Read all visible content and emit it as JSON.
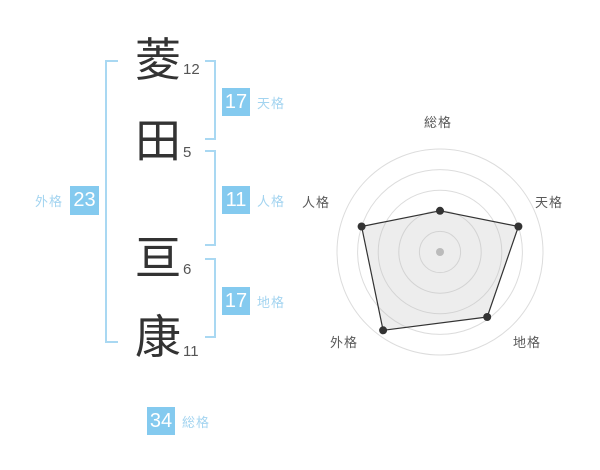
{
  "name_analysis": {
    "characters": [
      {
        "char": "菱",
        "strokes": "12"
      },
      {
        "char": "田",
        "strokes": "5"
      },
      {
        "char": "亘",
        "strokes": "6"
      },
      {
        "char": "康",
        "strokes": "11"
      }
    ],
    "scores": {
      "tenkaku": {
        "value": "17",
        "label": "天格"
      },
      "jinkaku": {
        "value": "11",
        "label": "人格"
      },
      "chikaku": {
        "value": "17",
        "label": "地格"
      },
      "gaikaku": {
        "value": "23",
        "label": "外格"
      },
      "soukaku": {
        "value": "34",
        "label": "総格"
      }
    }
  },
  "colors": {
    "accent_blue": "#84CAEF",
    "label_blue": "#A3D4F0",
    "bracket_blue": "#A9D8F2",
    "kanji_color": "#333333",
    "stroke_number_color": "#555555",
    "background": "#ffffff"
  },
  "chart_data": {
    "type": "radar",
    "axes": [
      "総格",
      "天格",
      "地格",
      "外格",
      "人格"
    ],
    "values": [
      2,
      4,
      3.9,
      4.7,
      4
    ],
    "max": 5,
    "rings": 5,
    "grid": "circular",
    "ring_color": "#dcdcdc",
    "line_color": "#333333",
    "point_color": "#333333",
    "fill_color": "rgba(190,190,190,0.28)",
    "center_dot_color": "#bbbbbb",
    "title": "",
    "legend": "none"
  }
}
